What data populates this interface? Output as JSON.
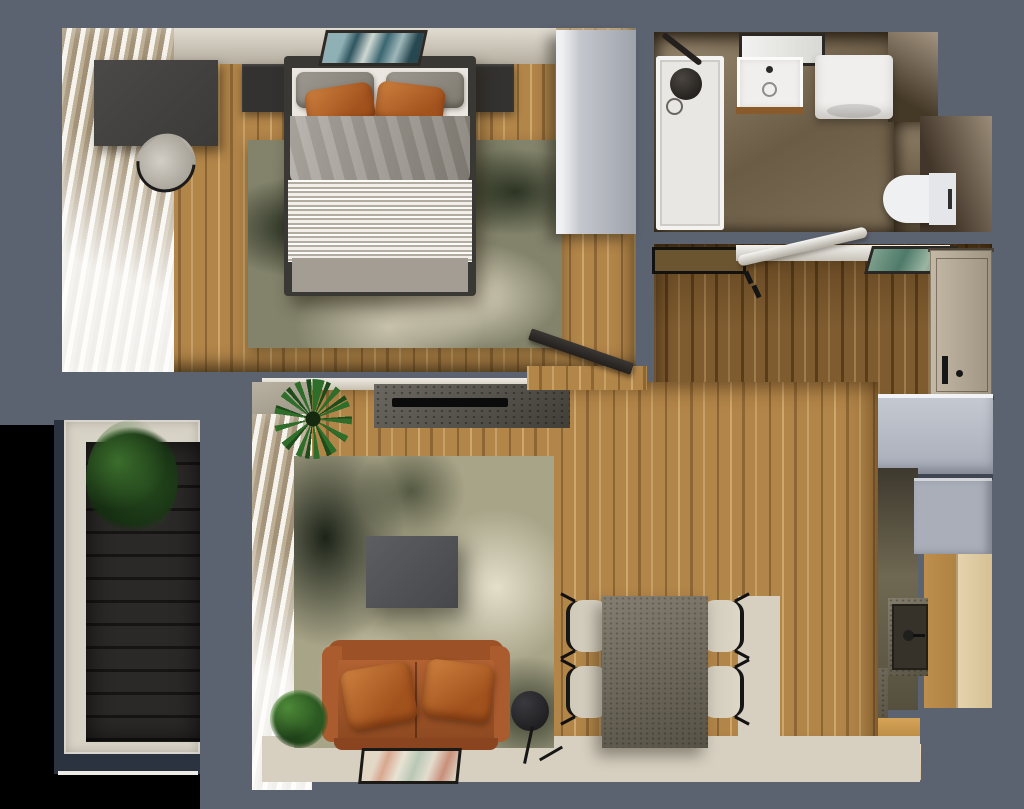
{
  "meta": {
    "title": "3D apartment floor plan — top-down render",
    "view": "top-down",
    "canvas": {
      "width": 1024,
      "height": 809
    }
  },
  "palette": {
    "outside": "#000000",
    "slab": "#5b6270",
    "wood": "#b28549",
    "wood-hall": "#7f5c30",
    "cream": "#d7d0c1",
    "sofa": "#a4572b",
    "duvet": "#9c968c",
    "linen": "#ebe7e0",
    "dark-furn": "#3a3835",
    "wardrobe": "#b6b9c1",
    "closet": "#b9bdc6",
    "counter": "#6e6754",
    "kwood": "#c99a52",
    "kwood-pale": "#e6d4ae",
    "tile": "#8a7a62",
    "fixture": "#f0efed",
    "deck": "#242221",
    "navy": "#2c3340",
    "door": "#b4a895",
    "tv": "#0b0b0b"
  },
  "rooms": {
    "bedroom": {
      "name": "bedroom",
      "items": [
        "double-bed",
        "gray-pillows",
        "leather-pillows",
        "nightstand-left",
        "nightstand-right",
        "desk",
        "desk-chair",
        "wardrobe",
        "distressed-olive-rug",
        "wall-art",
        "window-blinds",
        "open-door"
      ]
    },
    "bathroom": {
      "name": "bathroom",
      "items": [
        "shower-tray",
        "shower-fixture",
        "mirror",
        "sink-vanity",
        "washing-machine",
        "wall-hung-toilet",
        "stone-tile-floor"
      ]
    },
    "hallway": {
      "name": "entrance-hall",
      "items": [
        "door-mat",
        "wall-shelf",
        "coat-rod",
        "coat-hooks",
        "wall-art",
        "entrance-door",
        "built-in-closet"
      ]
    },
    "living_room": {
      "name": "living-room",
      "items": [
        "tv-console",
        "tv",
        "distressed-rug",
        "coffee-table",
        "leather-sofa",
        "leather-cushions",
        "floor-lamp",
        "dining-table",
        "dining-chairs-x4",
        "floor-art",
        "palm-plant",
        "small-plant",
        "window-blinds"
      ]
    },
    "kitchen": {
      "name": "kitchen",
      "items": [
        "gray-cabinet",
        "tall-wood-cabinet",
        "sink-counter",
        "sink",
        "faucet",
        "cooktop",
        "steel-trim",
        "dark-cabinet",
        "wood-island"
      ]
    },
    "balcony": {
      "name": "balcony",
      "items": [
        "dark-decking",
        "railing-frame",
        "potted-plant"
      ]
    }
  }
}
